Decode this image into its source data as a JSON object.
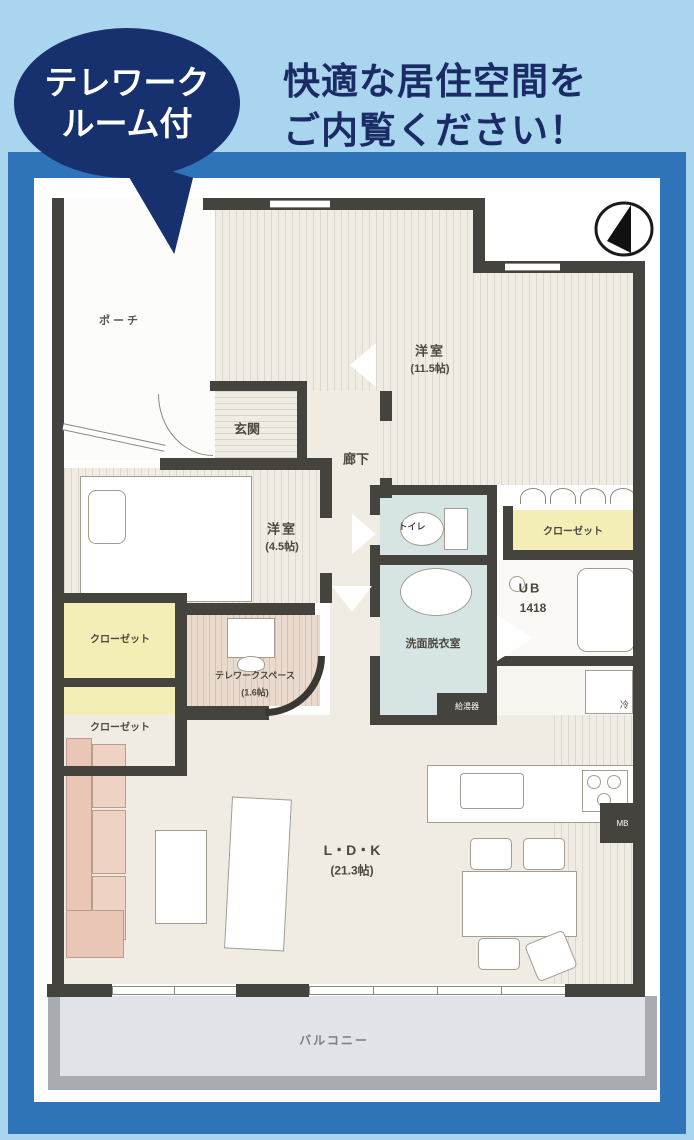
{
  "badge": {
    "line1": "テレワーク",
    "line2": "ルーム付"
  },
  "headline": {
    "line1": "快適な居住空間を",
    "line2": "ご内覧ください！"
  },
  "rooms": {
    "porch": "ポーチ",
    "western11": "洋室",
    "western11_size": "(11.5帖)",
    "entrance": "玄関",
    "hallway": "廊下",
    "western45": "洋室",
    "western45_size": "(4.5帖)",
    "toilet": "トイレ",
    "closet_right": "クローゼット",
    "unit_bath": "UB",
    "unit_bath_size": "1418",
    "washroom": "洗面脱衣室",
    "water_heater": "給湯器",
    "closet_left_upper": "クローゼット",
    "closet_left_lower": "クローゼット",
    "telework": "テレワークスペース",
    "telework_size": "(1.6帖)",
    "refrigerator": "冷",
    "ldk": "L・D・K",
    "ldk_size": "(21.3帖)",
    "meter_box": "MB",
    "balcony": "バルコニー"
  },
  "colors": {
    "background": "#a9d6ee",
    "frame_border": "#2f74b8",
    "badge": "#16316e",
    "headline_text": "#1b2b66",
    "wall": "#45433e",
    "closet_fill": "#f3eeb5",
    "wet_room_fill": "#d6e5e3",
    "room_fill": "#f0ece3",
    "balcony_fill": "#e0e3e7",
    "sofa_fill": "#e9c6b5"
  }
}
